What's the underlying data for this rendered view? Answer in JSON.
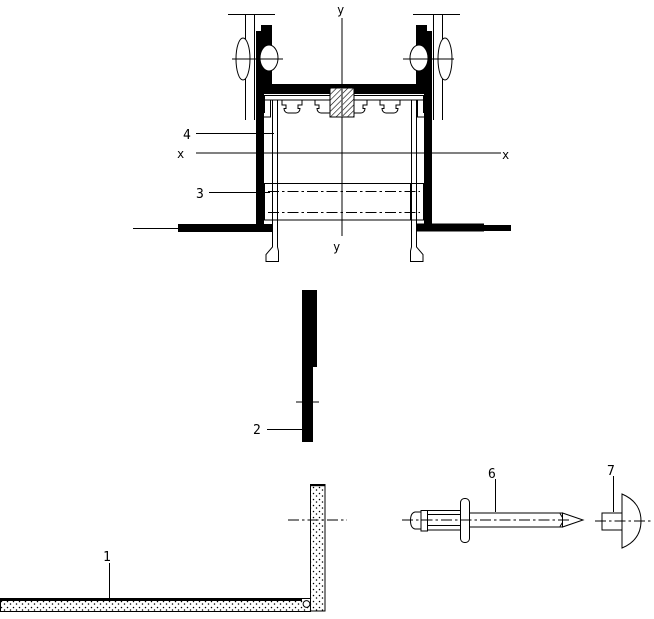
{
  "drawing": {
    "colors": {
      "ink": "#000000",
      "paper": "#ffffff"
    },
    "labels": {
      "part_1": "1",
      "part_2": "2",
      "part_3": "3",
      "part_4": "4",
      "part_6": "6",
      "part_7": "7",
      "axis_x_left": "x",
      "axis_x_right": "x",
      "axis_y_top": "y",
      "axis_y_bottom": "y"
    }
  }
}
